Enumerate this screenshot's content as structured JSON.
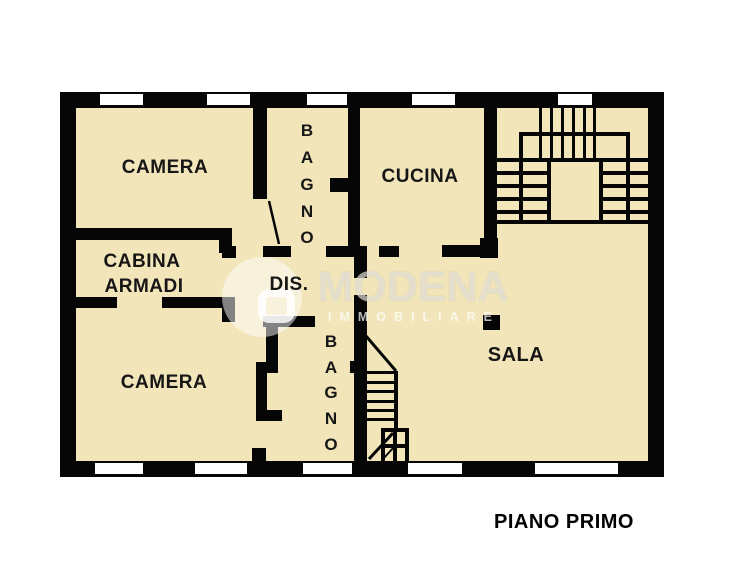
{
  "floor_title": "PIANO PRIMO",
  "watermark": {
    "brand": "MODENA",
    "tagline": "IMMOBILIARE"
  },
  "rooms": {
    "camera_top": {
      "label": "CAMERA"
    },
    "bagno_top": {
      "letters": [
        "B",
        "A",
        "G",
        "N",
        "O"
      ]
    },
    "cucina": {
      "label": "CUCINA"
    },
    "cabina_armadi": {
      "line1": "CABINA",
      "line2": "ARMADI"
    },
    "dis": {
      "label": "DIS."
    },
    "camera_bottom": {
      "label": "CAMERA"
    },
    "bagno_bottom": {
      "letters": [
        "B",
        "A",
        "G",
        "N",
        "O"
      ]
    },
    "sala": {
      "label": "SALA"
    }
  },
  "colors": {
    "floor": "#f1e5b9",
    "wall": "#060606",
    "background": "#ffffff",
    "label": "#161616"
  }
}
